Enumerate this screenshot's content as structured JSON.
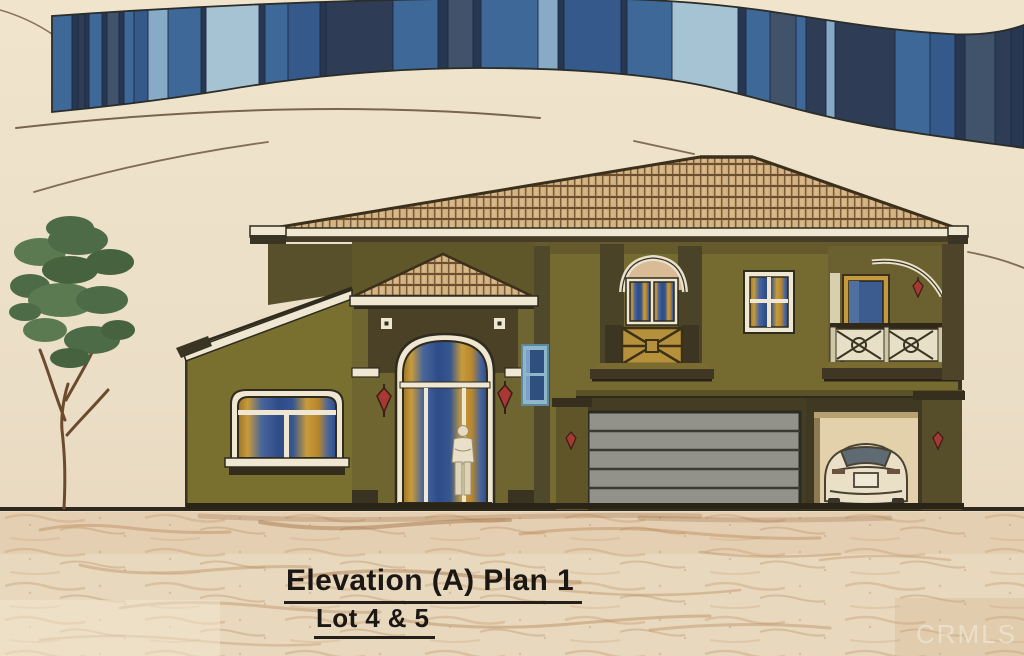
{
  "figure": {
    "title": "Elevation (A) Plan 1",
    "subtitle": "Lot 4 & 5",
    "watermark": "CRMLS",
    "kind": "architectural-elevation-rendering"
  },
  "palette": {
    "paper": "#ecdfc8",
    "banner_navy": "#273751",
    "banner_deep": "#2e3c55",
    "banner_mid": "#3e6898",
    "banner_mid2": "#36598b",
    "banner_slate": "#41526b",
    "banner_light": "#87abc6",
    "banner_pale": "#a6c3d4",
    "wall_olive": "#79702f",
    "wall_olive_dark": "#58502a",
    "roof_tile": "#cdaa7b",
    "trim_white": "#efe7d2",
    "glass_blue": "#2d4c88",
    "glass_gold": "#c89b3a",
    "garage_gray": "#92928a",
    "lantern_red": "#a83832",
    "tree_green": "#55714e",
    "ground_sand": "#c49a6e",
    "ink": "#241f18"
  },
  "banner": {
    "stripes": [
      [
        52,
        20,
        "mid"
      ],
      [
        72,
        6,
        "navy"
      ],
      [
        78,
        7,
        "deep"
      ],
      [
        85,
        4,
        "navy"
      ],
      [
        89,
        13,
        "mid"
      ],
      [
        102,
        5,
        "navy"
      ],
      [
        107,
        12,
        "slate"
      ],
      [
        119,
        5,
        "navy"
      ],
      [
        124,
        10,
        "mid"
      ],
      [
        134,
        14,
        "mid2"
      ],
      [
        148,
        20,
        "light"
      ],
      [
        168,
        33,
        "mid"
      ],
      [
        201,
        5,
        "navy"
      ],
      [
        206,
        53,
        "pale"
      ],
      [
        259,
        6,
        "navy"
      ],
      [
        265,
        23,
        "mid"
      ],
      [
        288,
        32,
        "mid2"
      ],
      [
        320,
        6,
        "navy"
      ],
      [
        326,
        67,
        "deep"
      ],
      [
        393,
        45,
        "mid"
      ],
      [
        438,
        10,
        "navy"
      ],
      [
        448,
        25,
        "slate"
      ],
      [
        473,
        8,
        "navy"
      ],
      [
        481,
        57,
        "mid"
      ],
      [
        538,
        20,
        "light"
      ],
      [
        558,
        6,
        "navy"
      ],
      [
        564,
        57,
        "mid2"
      ],
      [
        621,
        6,
        "navy"
      ],
      [
        627,
        45,
        "mid"
      ],
      [
        672,
        66,
        "pale"
      ],
      [
        738,
        8,
        "navy"
      ],
      [
        746,
        24,
        "mid"
      ],
      [
        770,
        26,
        "slate"
      ],
      [
        796,
        10,
        "mid"
      ],
      [
        806,
        20,
        "deep"
      ],
      [
        826,
        9,
        "light"
      ],
      [
        835,
        60,
        "deep"
      ],
      [
        895,
        35,
        "mid"
      ],
      [
        930,
        25,
        "mid2"
      ],
      [
        955,
        10,
        "navy"
      ],
      [
        965,
        30,
        "slate"
      ],
      [
        995,
        16,
        "deep"
      ],
      [
        1011,
        13,
        "navy"
      ]
    ]
  }
}
